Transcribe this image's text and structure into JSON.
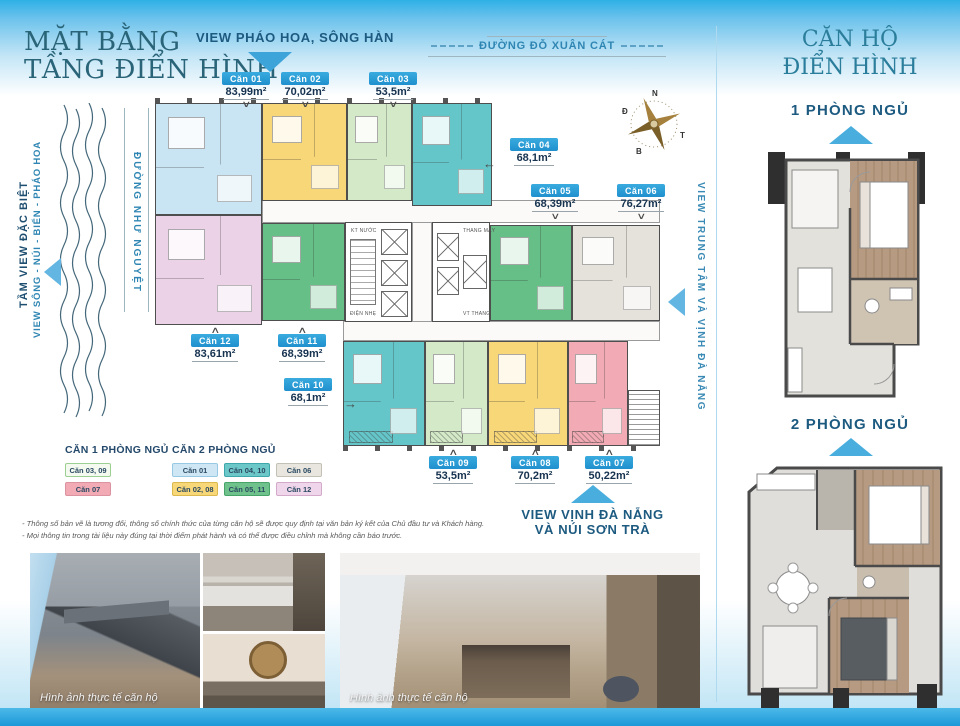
{
  "page": {
    "main_title_line1": "MẶT BẰNG",
    "main_title_line2": "TẦNG ĐIỂN HÌNH",
    "right_title_line1": "CĂN HỘ",
    "right_title_line2": "ĐIỂN HÌNH"
  },
  "view_labels": {
    "top": "VIEW PHÁO HOA, SÔNG HÀN",
    "right": "VIEW TRUNG TÂM VÀ VỊNH ĐÀ NẴNG",
    "bottom_line1": "VIEW VỊNH ĐÀ NẴNG",
    "bottom_line2": "VÀ NÚI SƠN TRÀ",
    "left_bold": "TẦM VIEW ĐẶC BIỆT",
    "left_sub": "VIEW SÔNG - NÚI - BIỂN - PHÁO HOA"
  },
  "roads": {
    "top": "ĐƯỜNG ĐỖ XUÂN CÁT",
    "left": "ĐƯỜNG NHƯ NGUYỆT"
  },
  "compass": {
    "top": "N",
    "left": "Đ",
    "right": "T",
    "bottom": "B"
  },
  "units": [
    {
      "id": "can-01",
      "label": "Căn 01",
      "area": "83,99m²",
      "color": "#c9e4f2"
    },
    {
      "id": "can-02",
      "label": "Căn 02",
      "area": "70,02m²",
      "color": "#f8d778"
    },
    {
      "id": "can-03",
      "label": "Căn 03",
      "area": "53,5m²",
      "color": "#d3e9c8"
    },
    {
      "id": "can-04",
      "label": "Căn 04",
      "area": "68,1m²",
      "color": "#65c6c9"
    },
    {
      "id": "can-05",
      "label": "Căn 05",
      "area": "68,39m²",
      "color": "#66bf86"
    },
    {
      "id": "can-06",
      "label": "Căn 06",
      "area": "76,27m²",
      "color": "#e4e2da"
    },
    {
      "id": "can-07",
      "label": "Căn 07",
      "area": "50,22m²",
      "color": "#f2aab4"
    },
    {
      "id": "can-08",
      "label": "Căn 08",
      "area": "70,2m²",
      "color": "#f8d778"
    },
    {
      "id": "can-09",
      "label": "Căn 09",
      "area": "53,5m²",
      "color": "#d3e9c8"
    },
    {
      "id": "can-10",
      "label": "Căn 10",
      "area": "68,1m²",
      "color": "#65c6c9"
    },
    {
      "id": "can-11",
      "label": "Căn 11",
      "area": "68,39m²",
      "color": "#66bf86"
    },
    {
      "id": "can-12",
      "label": "Căn 12",
      "area": "83,61m²",
      "color": "#ecd2e6"
    }
  ],
  "core_labels": {
    "kt_nuoc": "KT NƯỚC",
    "dien_nhe": "ĐIỆN NHẸ",
    "thang_may": "THANG MÁY",
    "vt_thang": "VT THANG"
  },
  "legend": {
    "group1_title": "CĂN 1 PHÒNG NGỦ",
    "group2_title": "CĂN 2 PHÒNG NGỦ",
    "group1": [
      {
        "label": "Căn 03, 09",
        "bg": "#f4faf0",
        "border": "#9ccf92"
      },
      {
        "label": "Căn 07",
        "bg": "#f2aab4",
        "border": "#dc93a0"
      }
    ],
    "group2": [
      {
        "label": "Căn 01",
        "bg": "#cfe7f4",
        "border": "#97c9e4"
      },
      {
        "label": "Căn 04, 10",
        "bg": "#6cc7c9",
        "border": "#3da8ab"
      },
      {
        "label": "Căn 06",
        "bg": "#e8e6de",
        "border": "#c3c0b5"
      },
      {
        "label": "Căn 02, 08",
        "bg": "#f8d778",
        "border": "#dcb94e"
      },
      {
        "label": "Căn 05, 11",
        "bg": "#6fc28b",
        "border": "#46a469"
      },
      {
        "label": "Căn 12",
        "bg": "#f0d6ea",
        "border": "#d4aacb"
      }
    ]
  },
  "unit_types": {
    "one_br_title": "1 PHÒNG NGỦ",
    "two_br_title": "2 PHÒNG NGỦ"
  },
  "disclaimer": [
    "- Thông số bản vẽ là tương đối, thông số chính thức của từng căn hộ sẽ được quy định tại văn bản ký kết của Chủ đầu tư và Khách hàng.",
    "- Mọi thông tin trong tài liệu này đúng tại thời điểm phát hành và có thể được điều chỉnh mà không cần báo trước."
  ],
  "photos": {
    "caption1": "Hình ảnh thực tế căn hộ",
    "caption2": "Hình ảnh thực tế căn hộ"
  },
  "colors": {
    "accent_blue": "#2d9fd6",
    "navy_text": "#1d4e70",
    "teal_title": "#2a6478",
    "road_blue": "#2f86b3"
  }
}
